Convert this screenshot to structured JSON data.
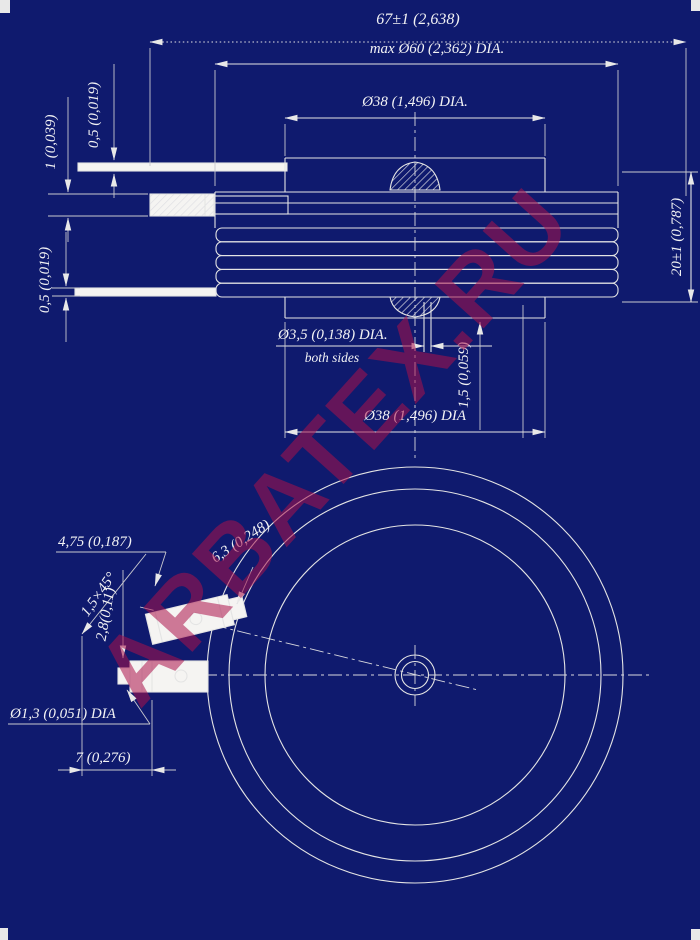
{
  "watermark": {
    "text": "ARBATEX.RU",
    "color": "#a8124a"
  },
  "colors": {
    "background": "#0f1a6e",
    "line": "#e4e4e4",
    "fill_white": "#f5f4f2",
    "watermark_red": "rgba(172,18,74,0.55)"
  },
  "side_view": {
    "overall_width": "67±1 (2,638)",
    "case_diameter": "max Ø60 (2,362) DIA.",
    "top_pole_diameter": "Ø38 (1,496) DIA.",
    "upper_lead_thickness": "0,5 (0,019)",
    "lead_spacing": "1 (0,039)",
    "lower_lead_thickness": "0,5 (0,019)",
    "case_height": "20±1 (0,787)",
    "hole_diameter": "Ø3,5 (0,138) DIA.",
    "hole_note": "both sides",
    "hole_offset": "1,5 (0,059)",
    "bottom_pole_diameter": "Ø38 (1,496) DIA"
  },
  "bottom_view": {
    "gate_terminal_width": "4,75 (0,187)",
    "gate_terminal_length": "6,3 (0,248)",
    "chamfer": "1,5×45°",
    "terminal_offset": "2,8(0,11)",
    "wire_diameter": "Ø1,3 (0,051) DIA",
    "lead_protrusion": "7 (0,276)"
  }
}
